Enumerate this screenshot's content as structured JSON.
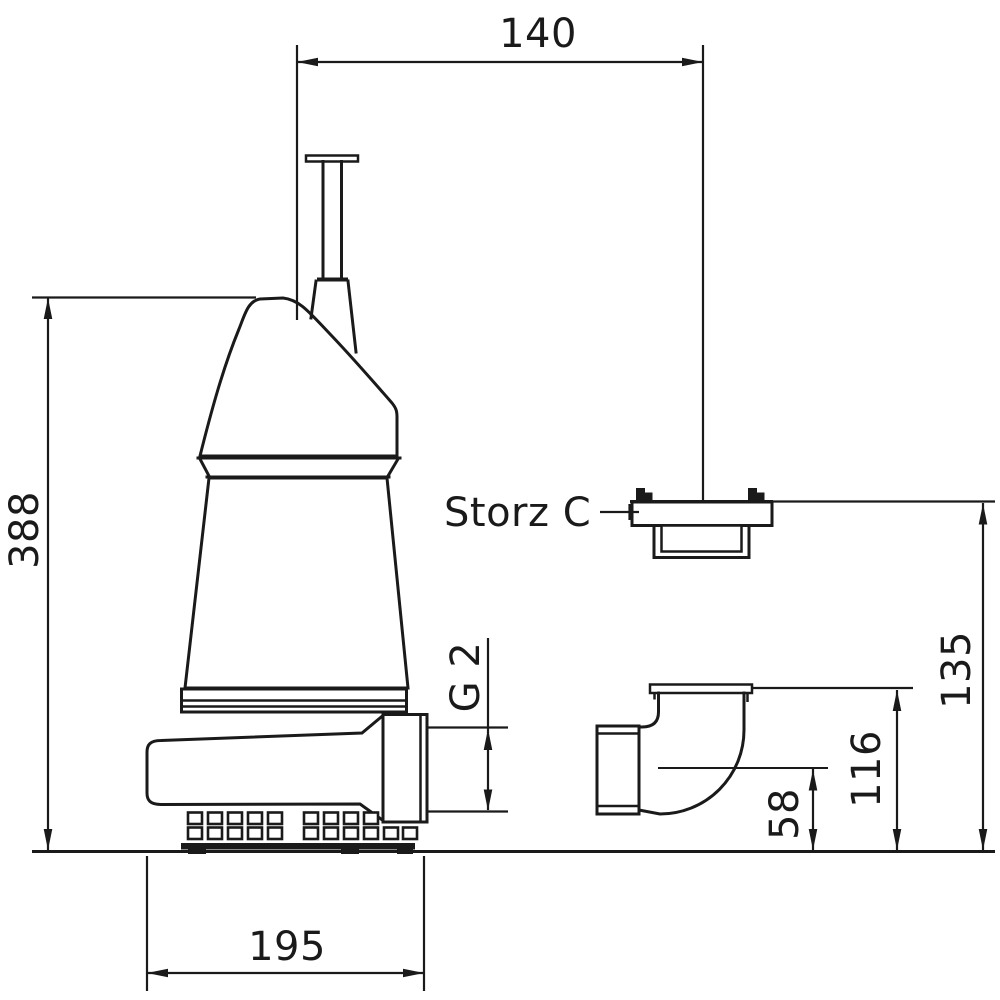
{
  "drawing": {
    "dimensions": {
      "top_width": "140",
      "overall_height": "388",
      "base_width": "195",
      "discharge_thread": "G 2",
      "coupling_height": "135",
      "elbow_flange_height": "116",
      "elbow_center_height": "58"
    },
    "labels": {
      "coupling": "Storz C"
    },
    "colors": {
      "line": "#1a1a1a",
      "background": "#ffffff"
    }
  }
}
